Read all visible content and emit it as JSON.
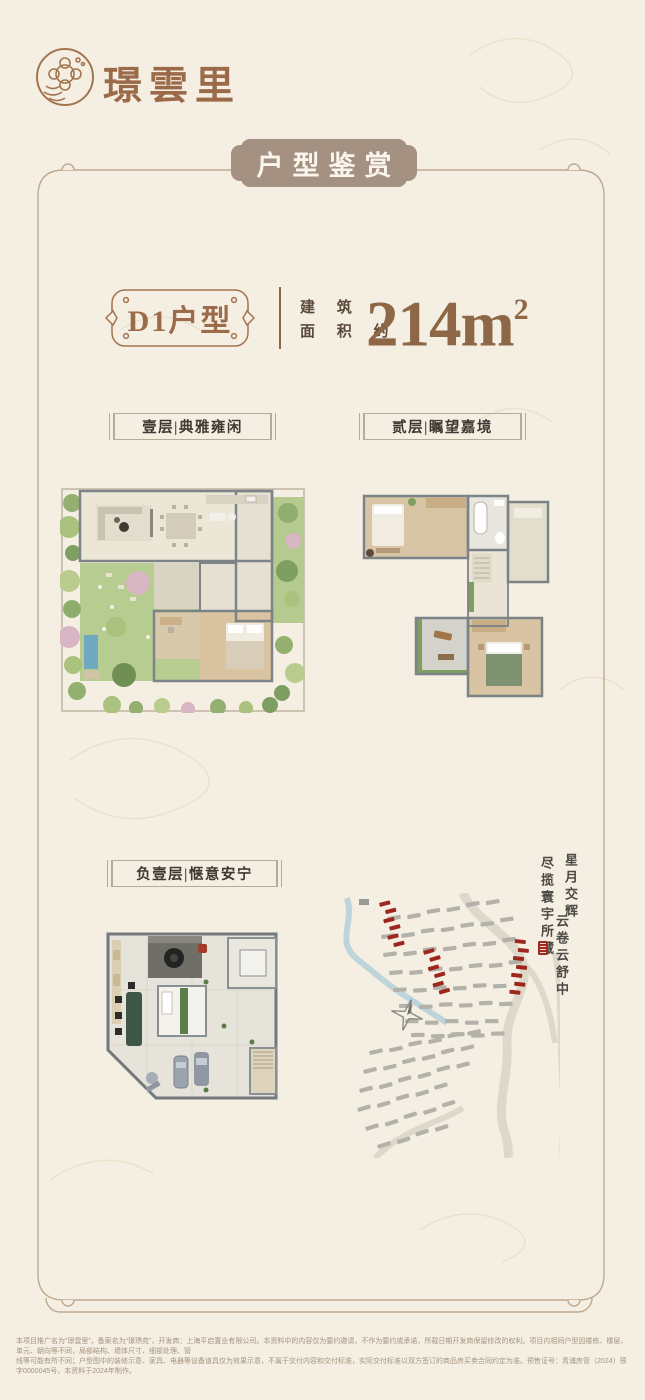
{
  "brand": {
    "name": "璟雲里"
  },
  "header": {
    "badge": "户型鉴赏"
  },
  "unit": {
    "name": "D1户型",
    "area_label_top": "建 筑",
    "area_label_bottom": "面 积 约",
    "area_value": "214m",
    "area_sup": "2"
  },
  "floors": {
    "floor1": {
      "label": "壹层|典雅雍闲"
    },
    "floor2": {
      "label": "贰层|瞩望嘉境"
    },
    "basement": {
      "label": "负壹层|惬意安宁"
    }
  },
  "poem": {
    "line1a": "星月交辉",
    "line1b": "云卷云舒中",
    "line2": "尽揽寰宇所藏"
  },
  "colors": {
    "accent_brown": "#9c6b4a",
    "badge_taupe": "#a59181",
    "map_building_gray": "#b2b2ab",
    "map_highlight_red": "#9d271c",
    "river_blue": "#b7d2d8"
  },
  "disclaimer": {
    "line1": "本项目推广名为“璟雲里”，备案名为“璟琇苑”，开发商：上海平启置业有限公司。本资料中的内容仅为要约邀请，不作为要约或承诺，所载日期开发商保留修改的权利。项目内相同户型因楼栋、楼层、单元、朝向等不同，局部结构、墙体尺寸、细部处理、管",
    "line2": "线等可能有所不同；户型图中的装修示意、家具、电器等设备道具仅为效果示意，不属于交付内容和交付标准，实际交付标准以双方签订的商品房买卖合同约定为准。预售证号：青浦房管（2024）预字0000045号，本资料于2024年制作。"
  }
}
